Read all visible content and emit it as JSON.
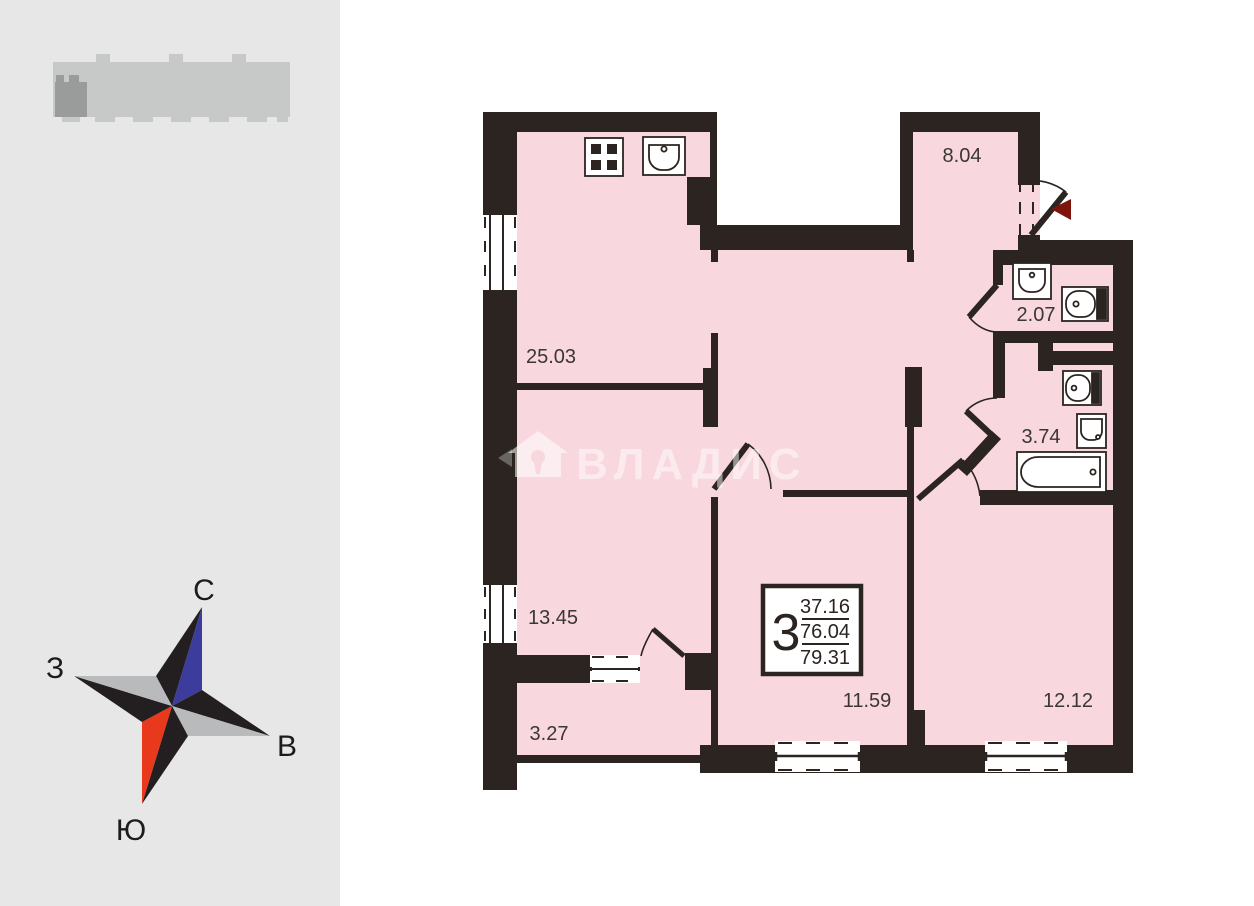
{
  "plan": {
    "rooms": [
      {
        "name": "hallway",
        "area": "8.04"
      },
      {
        "name": "kitchen-living",
        "area": "25.03"
      },
      {
        "name": "wc",
        "area": "2.07"
      },
      {
        "name": "bathroom",
        "area": "3.74"
      },
      {
        "name": "bedroom-1",
        "area": "13.45"
      },
      {
        "name": "loggia",
        "area": "3.27"
      },
      {
        "name": "room-2",
        "area": "11.59"
      },
      {
        "name": "room-3",
        "area": "12.12"
      }
    ],
    "info_box": {
      "rooms_count": "3",
      "living_area": "37.16",
      "usable_area": "76.04",
      "total_area": "79.31"
    },
    "watermark_text": "ВЛАДИС"
  },
  "sidebar": {
    "compass": {
      "north": "С",
      "south": "Ю",
      "west": "З",
      "east": "В"
    }
  },
  "colors": {
    "wall": "#2b2420",
    "room_fill": "#f8d7df",
    "sidebar_bg": "#e7e7e7",
    "building_light": "#c7c9c8",
    "building_dark": "#9a9c9b",
    "compass_red": "#e8391d",
    "compass_blue": "#3c3c9c",
    "compass_gray": "#b9babc",
    "compass_black": "#231f20",
    "entry_marker": "#7d150d",
    "label_color": "#3b3733"
  }
}
